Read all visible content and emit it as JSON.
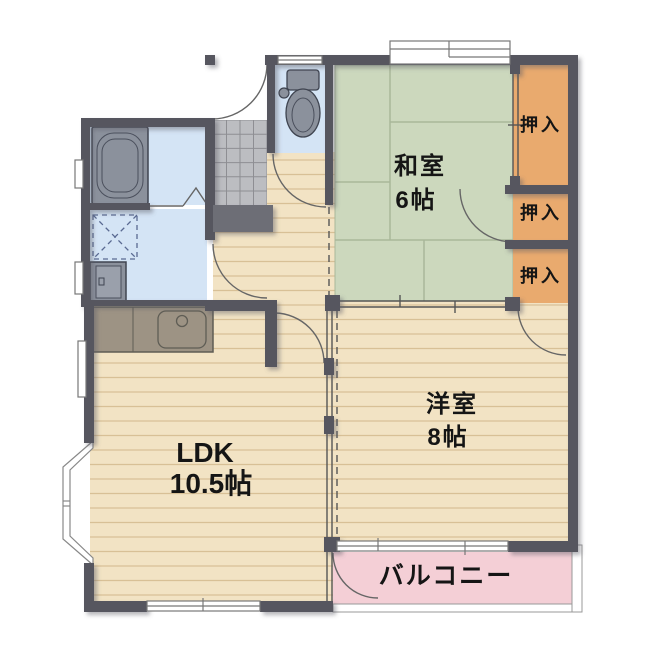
{
  "rooms": {
    "washitsu": {
      "name": "和室",
      "size": "6帖"
    },
    "western": {
      "name": "洋室",
      "size": "8帖"
    },
    "ldk": {
      "name": "LDK",
      "size": "10.5帖"
    },
    "balcony": {
      "name": "バルコニー"
    },
    "closets": [
      {
        "label": "押入"
      },
      {
        "label": "押入"
      },
      {
        "label": "押入"
      }
    ]
  },
  "fixtures": [
    "bathtub",
    "toilet",
    "washbasin",
    "washing-machine-pan",
    "kitchen-counter",
    "kitchen-sink",
    "bay-window",
    "entrance-tile"
  ],
  "colors": {
    "wall": "#56575f",
    "tatami_green": "#ccd8bd",
    "flooring_beige": "#f2e3c4",
    "plank_line": "#d8c096",
    "closet_orange": "#e9aa6e",
    "balcony_pink": "#f4cfd6",
    "water_area_blue": "#d4e4f5",
    "genkan_tile": "#bcbdc1",
    "fixture_gray": "#8b919c"
  }
}
